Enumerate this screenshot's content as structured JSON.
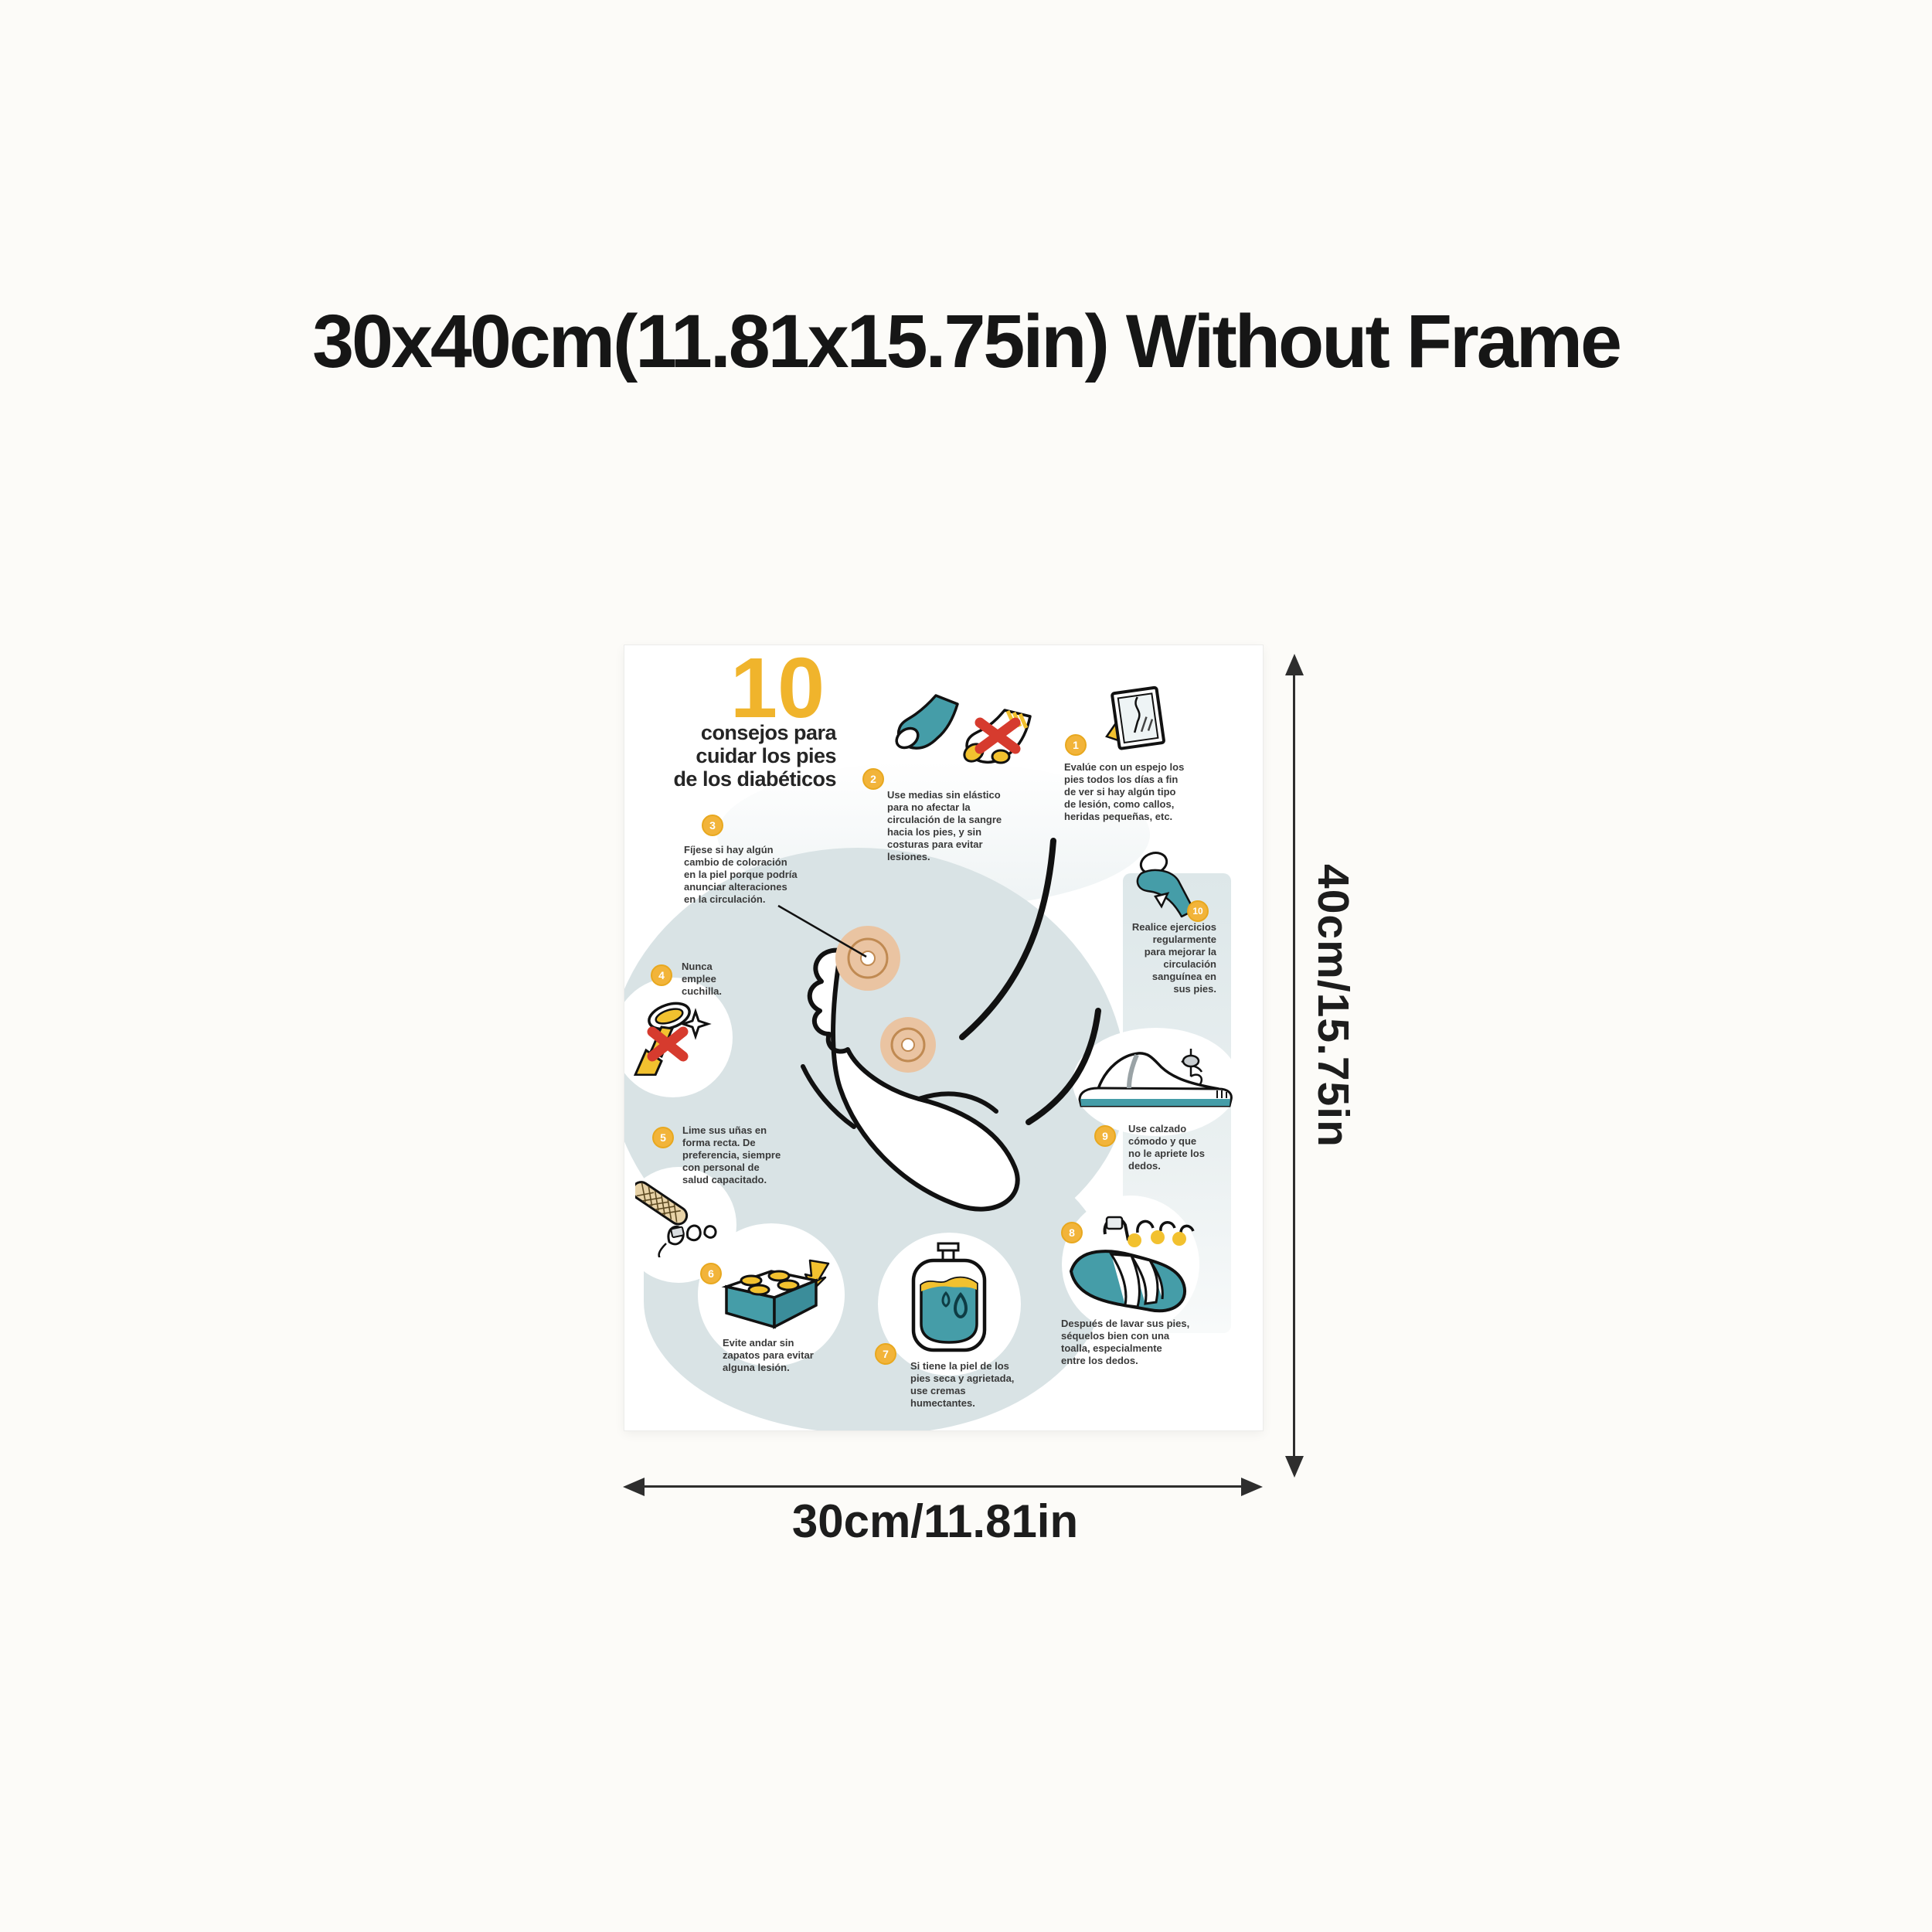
{
  "header": {
    "title": "30x40cm(11.81x15.75in) Without Frame"
  },
  "poster": {
    "heading": {
      "number": "10",
      "lines": "consejos para\ncuidar los pies\nde los diabéticos"
    },
    "tips": [
      {
        "num": "1",
        "icon": "mirror-icon",
        "text": "Evalúe con un espejo los\npies todos los días a fin\nde ver si hay algún tipo\nde lesión, como callos,\nheridas pequeñas, etc."
      },
      {
        "num": "2",
        "icon": "socks-icon",
        "text": "Use medias sin elástico\npara no afectar la\ncirculación de la sangre\nhacia los pies, y sin\ncosturas para evitar\nlesiones."
      },
      {
        "num": "3",
        "icon": "foot-callout",
        "text": "Fíjese si hay algún\ncambio de coloración\nen la piel porque podría\nanunciar alteraciones\nen la circulación."
      },
      {
        "num": "4",
        "icon": "razor-icon",
        "text": "Nunca\nemplee\ncuchilla."
      },
      {
        "num": "5",
        "icon": "nail-file-icon",
        "text": "Lime sus uñas en\nforma recta. De\npreferencia, siempre\ncon personal de\nsalud capacitado."
      },
      {
        "num": "6",
        "icon": "lego-brick-icon",
        "text": "Evite andar sin\nzapatos para evitar\nalguna lesión."
      },
      {
        "num": "7",
        "icon": "lotion-icon",
        "text": "Si tiene la piel de los\npies seca y agrietada,\nuse cremas\nhumectantes."
      },
      {
        "num": "8",
        "icon": "towel-icon",
        "text": "Después de lavar sus pies,\nséquelos bien con una\ntoalla, especialmente\nentre los dedos."
      },
      {
        "num": "9",
        "icon": "shoe-icon",
        "text": "Use calzado\ncómodo y que\nno le apriete los\ndedos."
      },
      {
        "num": "10",
        "icon": "exercise-icon",
        "text": "Realice ejercicios\nregularmente\npara mejorar la\ncirculación\nsanguínea en\nsus pies."
      }
    ],
    "colors": {
      "accent_yellow": "#f0b42c",
      "teal": "#459da8",
      "alert_red": "#d63b2e",
      "blob_gray": "#d9e3e5",
      "callus_orange": "#eac4a2"
    }
  },
  "dimensions": {
    "height_label": "40cm/15.75in",
    "width_label": "30cm/11.81in"
  }
}
